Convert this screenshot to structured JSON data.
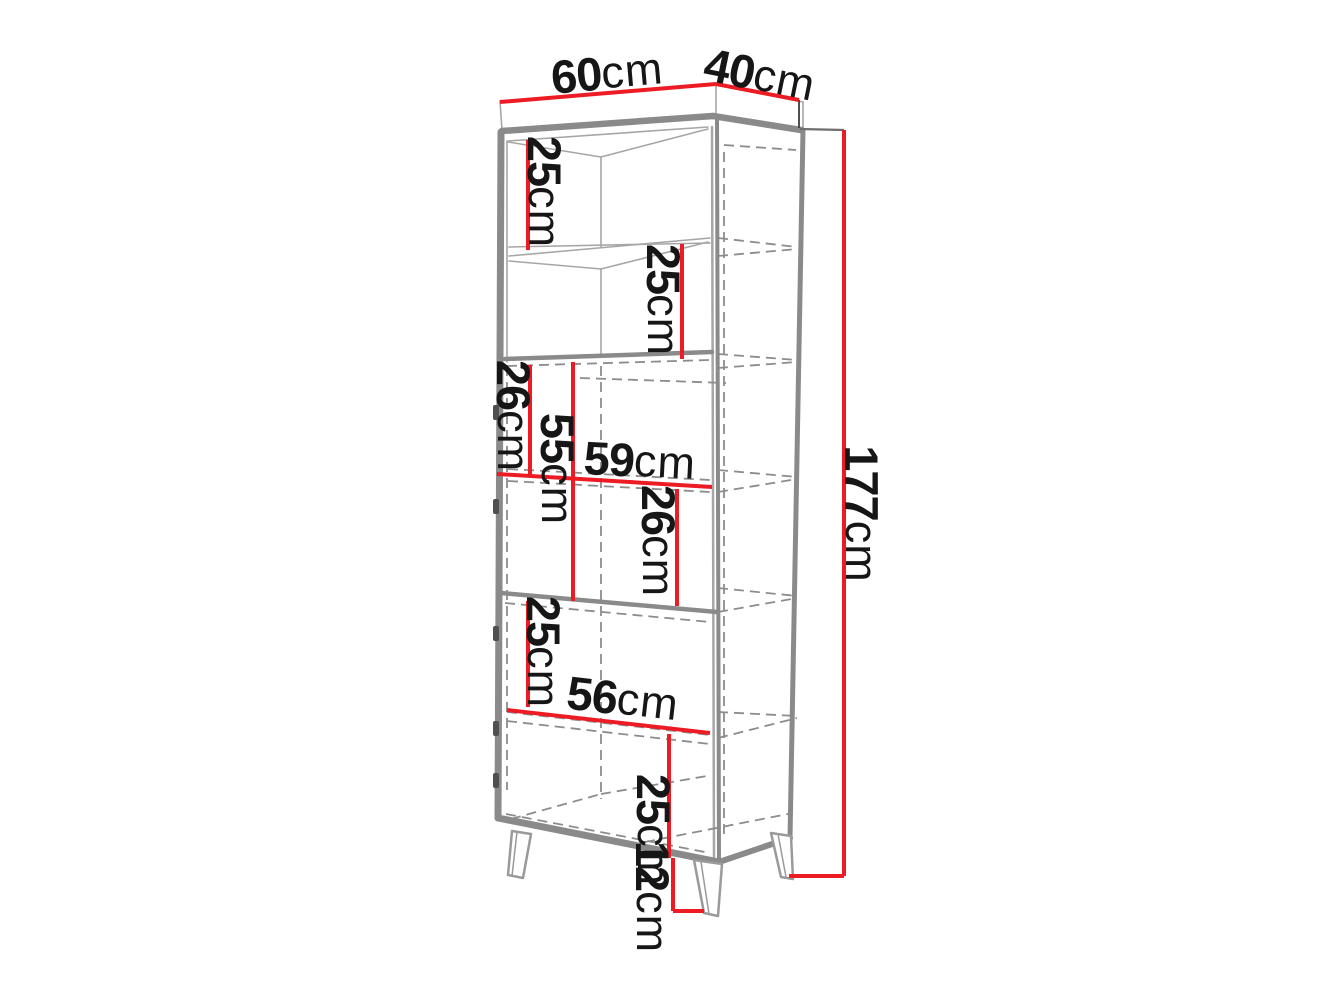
{
  "diagram": {
    "title": "bookcase-dimension-drawing",
    "colors": {
      "dimension_red": "#ED1C24",
      "structure_gray": "#8a8a8a",
      "line_light": "#a6a6a6",
      "line_dashed": "#8c8c8c",
      "edge_dark": "#3c3c3c",
      "connector_gray": "#6f6f6f",
      "text": "#161616",
      "background": "#ffffff"
    },
    "labels": [
      {
        "name": "top-width",
        "value": "60",
        "unit": "cm"
      },
      {
        "name": "top-depth",
        "value": "40",
        "unit": "cm"
      },
      {
        "name": "total-height",
        "value": "177",
        "unit": "cm"
      },
      {
        "name": "compartment-1-height",
        "value": "25",
        "unit": "cm"
      },
      {
        "name": "compartment-2-height",
        "value": "25",
        "unit": "cm"
      },
      {
        "name": "compartment-3-height",
        "value": "26",
        "unit": "cm"
      },
      {
        "name": "middle-section-height",
        "value": "55",
        "unit": "cm"
      },
      {
        "name": "middle-inner-width",
        "value": "59",
        "unit": "cm"
      },
      {
        "name": "compartment-4-height",
        "value": "26",
        "unit": "cm"
      },
      {
        "name": "compartment-5-height",
        "value": "25",
        "unit": "cm"
      },
      {
        "name": "lower-inner-width",
        "value": "56",
        "unit": "cm"
      },
      {
        "name": "compartment-6-height",
        "value": "25",
        "unit": "cm"
      },
      {
        "name": "leg-height",
        "value": "12",
        "unit": "cm"
      }
    ]
  }
}
